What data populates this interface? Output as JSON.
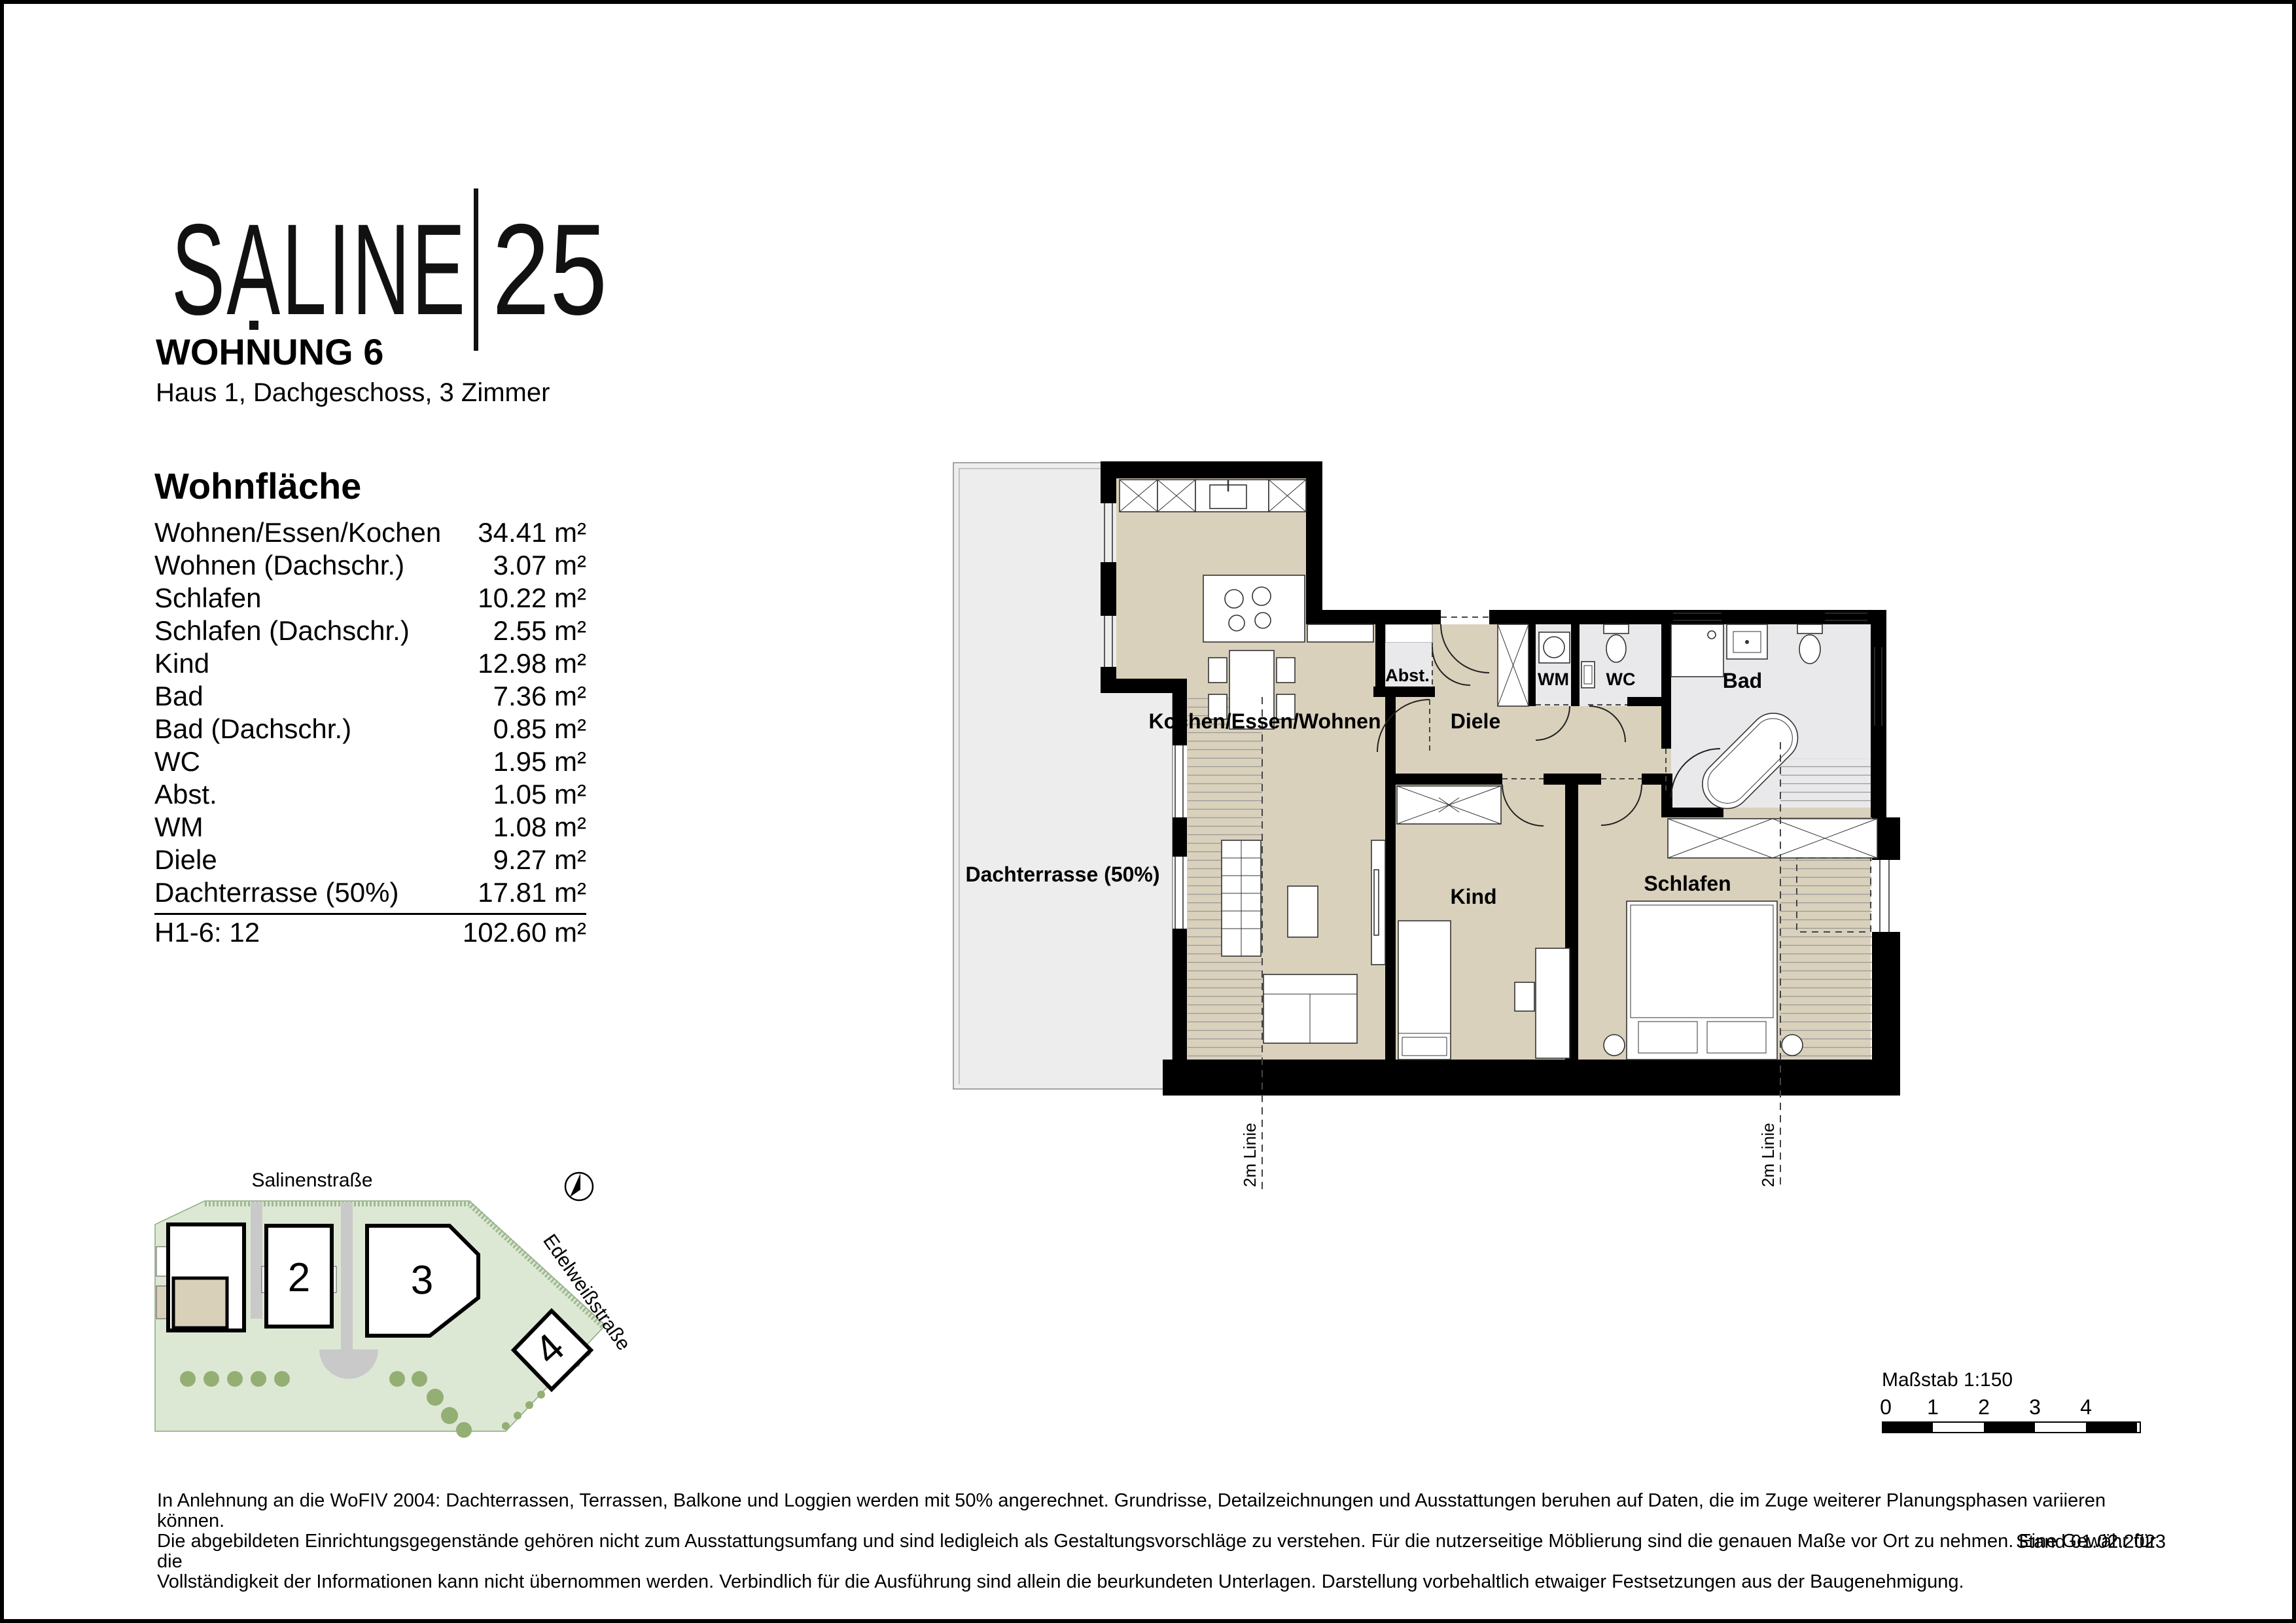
{
  "logo": {
    "brand": "SALINE",
    "number": "25"
  },
  "header": {
    "title": "WOHNUNG 6",
    "subtitle": "Haus 1, Dachgeschoss, 3 Zimmer"
  },
  "area_table": {
    "heading": "Wohnfläche",
    "rows": [
      {
        "label": "Wohnen/Essen/Kochen",
        "value": "34.41 m²"
      },
      {
        "label": "Wohnen (Dachschr.)",
        "value": "3.07 m²"
      },
      {
        "label": "Schlafen",
        "value": "10.22 m²"
      },
      {
        "label": "Schlafen (Dachschr.)",
        "value": "2.55 m²"
      },
      {
        "label": "Kind",
        "value": "12.98 m²"
      },
      {
        "label": "Bad",
        "value": "7.36 m²"
      },
      {
        "label": "Bad (Dachschr.)",
        "value": "0.85 m²"
      },
      {
        "label": "WC",
        "value": "1.95 m²"
      },
      {
        "label": "Abst.",
        "value": "1.05 m²"
      },
      {
        "label": "WM",
        "value": "1.08 m²"
      },
      {
        "label": "Diele",
        "value": "9.27 m²"
      },
      {
        "label": "Dachterrasse (50%)",
        "value": "17.81 m²"
      }
    ],
    "total": {
      "label": "H1-6: 12",
      "value": "102.60 m²"
    }
  },
  "floorplan": {
    "rooms": {
      "kochen": "Kochen/Essen/Wohnen",
      "diele": "Diele",
      "abst": "Abst.",
      "wm": "WM",
      "wc": "WC",
      "bad": "Bad",
      "kind": "Kind",
      "schlafen": "Schlafen",
      "terrasse": "Dachterrasse (50%)"
    },
    "lines": [
      "2m Linie",
      "2m Linie"
    ]
  },
  "siteplan": {
    "street_top": "Salinenstraße",
    "street_right": "Edelweißstraße",
    "buildings": [
      "2",
      "3",
      "4"
    ]
  },
  "scalebar": {
    "label": "Maßstab 1:150",
    "ticks": [
      "0",
      "1",
      "2",
      "3",
      "4"
    ]
  },
  "footer": {
    "lines": [
      "In Anlehnung an die WoFIV 2004: Dachterrassen, Terrassen, Balkone und Loggien werden mit 50% angerechnet. Grundrisse, Detailzeichnungen und Ausstattungen beruhen auf Daten, die im Zuge weiterer Planungsphasen variieren können.",
      "Die abgebildeten Einrichtungsgegenstände gehören nicht zum Ausstattungsumfang und sind ledigleich als Gestaltungsvorschläge zu verstehen. Für die nutzerseitige Möblierung sind die genauen Maße vor Ort zu nehmen. Eine Gewähr für die",
      "Vollständigkeit der Informationen kann nicht übernommen werden. Verbindlich für die Ausführung sind allein die beurkundeten Unterlagen. Darstellung vorbehaltlich etwaiger Festsetzungen aus der Baugenehmigung."
    ],
    "stand": "Stand 01.02.2023"
  },
  "colors": {
    "room_beige": "#d9d1bc",
    "terrace_gray": "#ededed",
    "wet_room_gray": "#e9e9eb",
    "site_green": "#dde8d4",
    "tree_green": "#94af74",
    "wall_black": "#000000"
  }
}
